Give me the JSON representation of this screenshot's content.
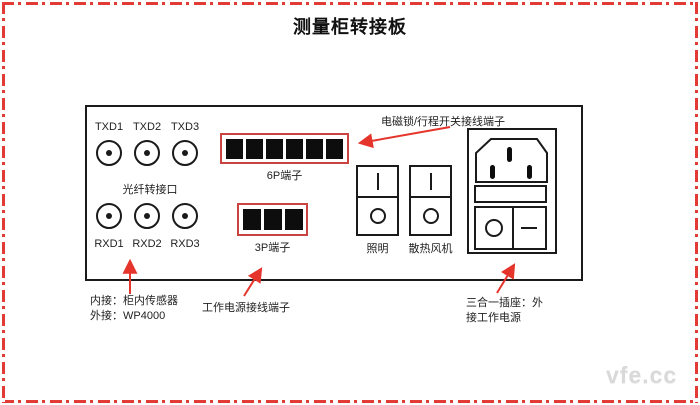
{
  "page": {
    "title": "测量柜转接板",
    "watermark": "vfe.cc"
  },
  "colors": {
    "frame_red": "#e23b36",
    "terminal_box_red": "#c94343",
    "arrow_red": "#e5342b",
    "line_black": "#1a1a1a",
    "watermark_gray": "#d9d9d9"
  },
  "panel": {
    "fiber_section": {
      "label": "光纤转接口",
      "tx_ports": [
        "TXD1",
        "TXD2",
        "TXD3"
      ],
      "rx_ports": [
        "RXD1",
        "RXD2",
        "RXD3"
      ]
    },
    "terminal_6p": {
      "label": "6P端子",
      "pin_count": 6
    },
    "terminal_3p": {
      "label": "3P端子",
      "pin_count": 3
    },
    "switches": {
      "light_label": "照明",
      "fan_label": "散热风机"
    }
  },
  "annotations": {
    "lock_terminal_label": "电磁锁/行程开关接线端子",
    "fiber_note_line1": "内接：柜内传感器",
    "fiber_note_line2": "外接：WP4000",
    "power_terminal_label": "工作电源接线端子",
    "socket_note_line1": "三合一插座：外",
    "socket_note_line2": "接工作电源"
  }
}
